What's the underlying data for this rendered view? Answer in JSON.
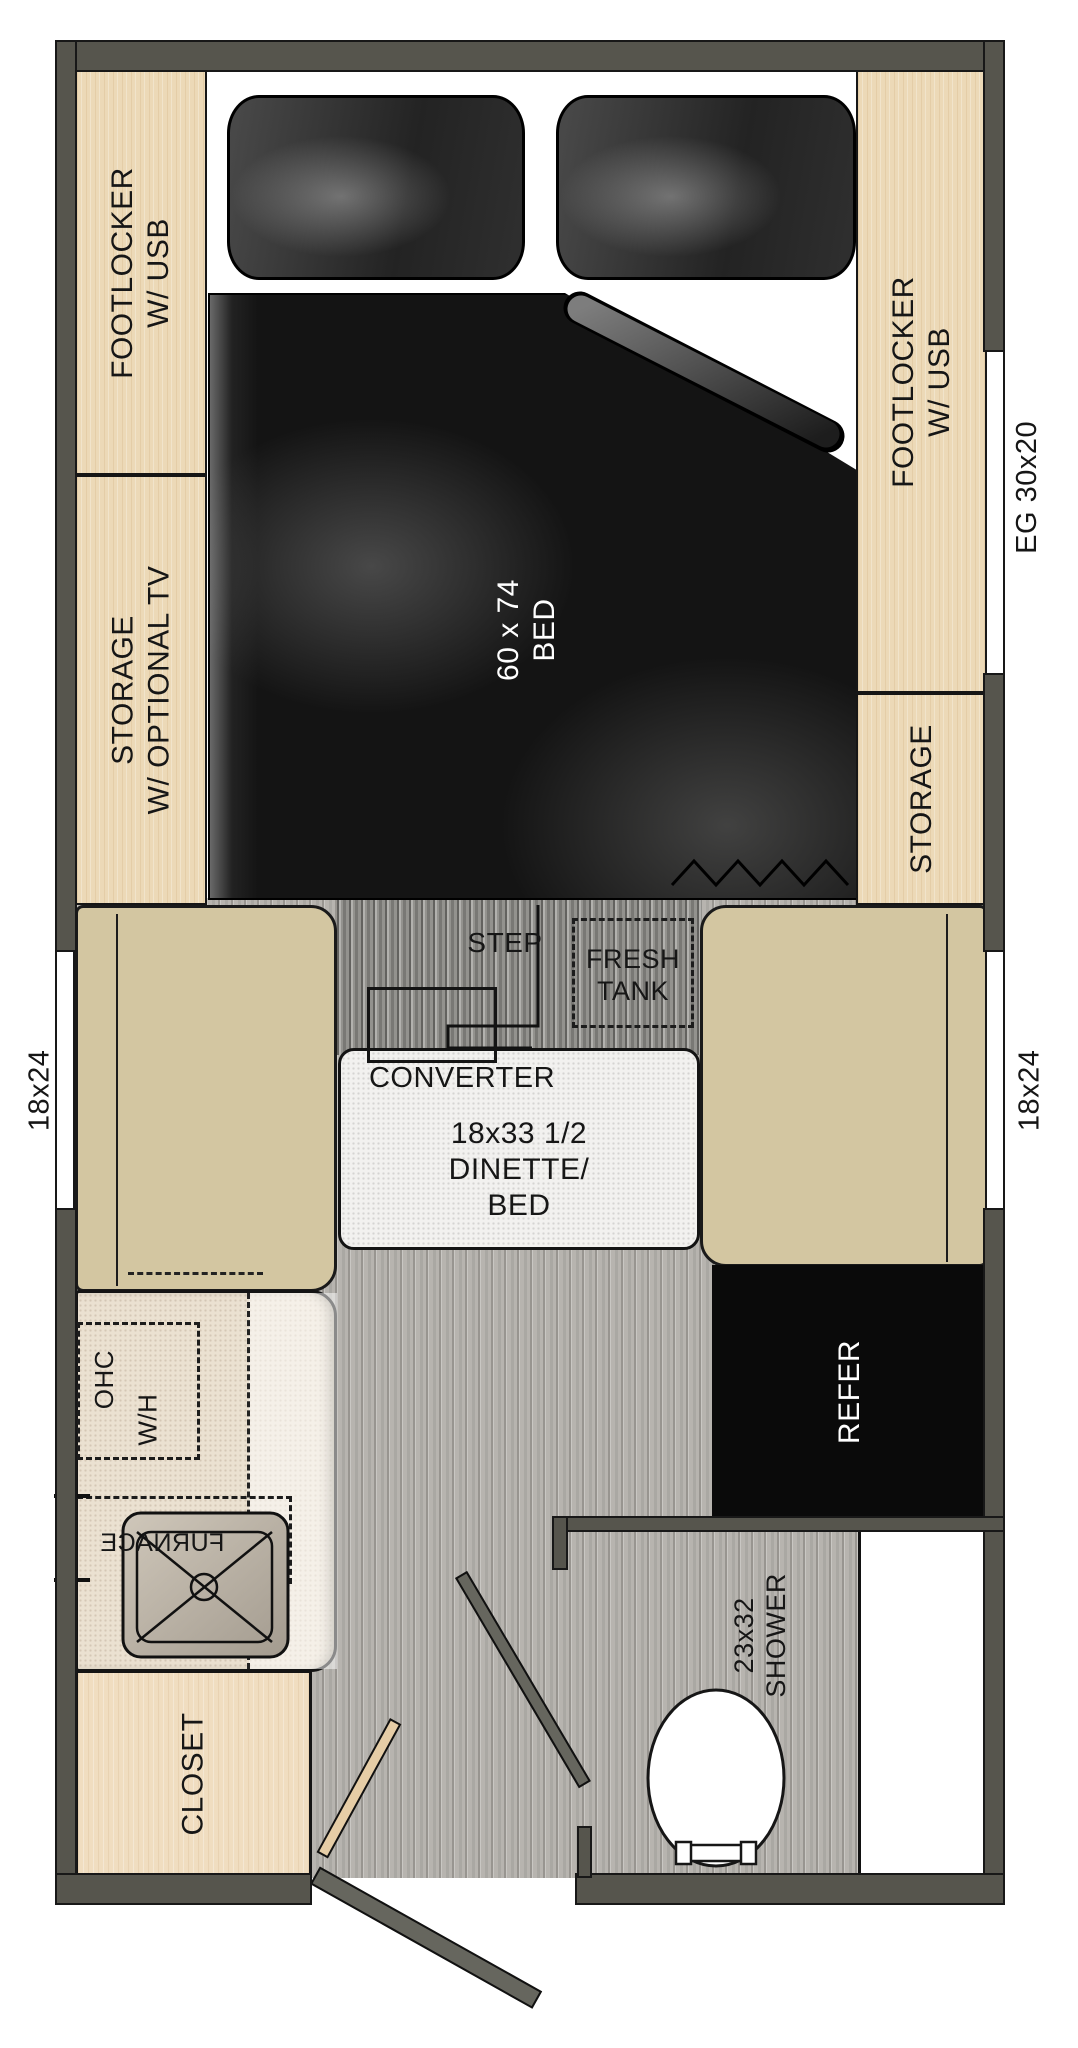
{
  "plan_title": "travel trailer floor plan",
  "labels": {
    "footlocker_left": {
      "line1": "FOOTLOCKER",
      "line2": "W/ USB"
    },
    "storage_left": {
      "line1": "STORAGE",
      "line2": "W/ OPTIONAL TV"
    },
    "footlocker_right": {
      "line1": "FOOTLOCKER",
      "line2": "W/ USB"
    },
    "storage_right": "STORAGE",
    "egress_window": "EG 30x20",
    "bed": {
      "line1": "60 x 74",
      "line2": "BED"
    },
    "window_left": "18x24",
    "window_right": "18x24",
    "step": "STEP",
    "fresh_tank": {
      "line1": "FRESH",
      "line2": "TANK"
    },
    "converter": "CONVERTER",
    "dinette": {
      "line1": "18x33 1/2",
      "line2": "DINETTE/",
      "line3": "BED"
    },
    "ohc": "OHC",
    "water_heater": "W/H",
    "furnace": "FURNACE",
    "refrigerator": "REFER",
    "shower": {
      "line1": "23x32",
      "line2": "SHOWER"
    },
    "closet": "CLOSET"
  },
  "colors": {
    "wall": "#56554d",
    "cabinet_wood": "#ecd9b7",
    "seat_tan": "#d3c6a1",
    "mattress_black": "#141414",
    "refrigerator_black": "#0a0a0a",
    "floor_gray": "#b7b4af",
    "table_white": "#f2f1ef",
    "door_gray": "#66665e",
    "door_wood": "#e6cda6"
  }
}
